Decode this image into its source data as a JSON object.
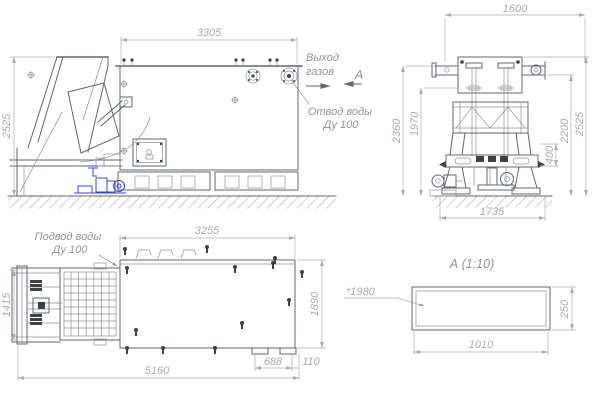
{
  "annotations": {
    "gas_outlet": {
      "line1": "Выход",
      "line2": "газов"
    },
    "water_drain": {
      "line1": "Отвод воды",
      "line2": "Ду 100"
    },
    "water_supply": {
      "line1": "Подвод воды",
      "line2": "Ду 100"
    },
    "section_arrow": "А",
    "section_title": "А  (1:10)",
    "level_mark": "*1980"
  },
  "dimensions": {
    "side": {
      "height": "2525",
      "length": "3305"
    },
    "front": {
      "width_top": "1600",
      "height_left_outer": "2360",
      "height_left_inner": "1970",
      "height_right_inner": "2200",
      "height_right_outer": "2525",
      "beam": "400",
      "base": "1735"
    },
    "plan": {
      "length_top": "3255",
      "width_left": "1415",
      "width_right": "1890",
      "foot_span": "688",
      "foot_offset": "110",
      "length_total": "5160"
    },
    "section": {
      "width": "1010",
      "height": "250"
    }
  },
  "colors": {
    "line": "#5f6670",
    "dimension": "#a6abb3",
    "annotation": "#8d929a",
    "accent_blue": "#3a46c0",
    "bolt": "#3c4148"
  }
}
